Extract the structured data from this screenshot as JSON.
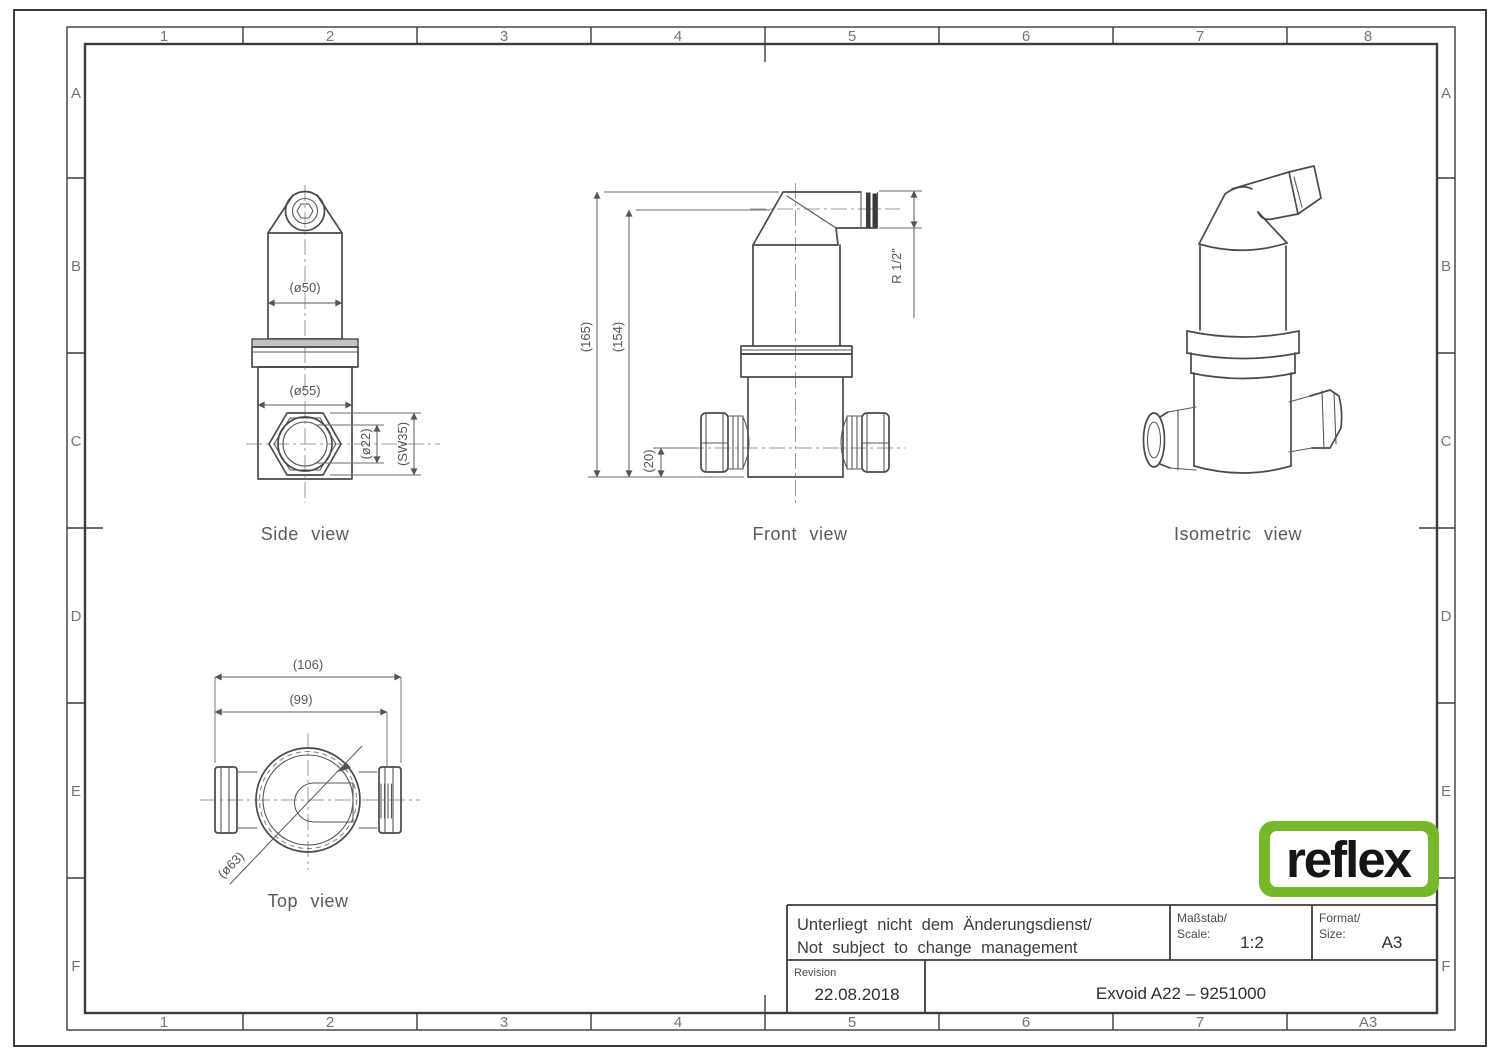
{
  "frame": {
    "cols_top": [
      "1",
      "2",
      "3",
      "4",
      "5",
      "6",
      "7",
      "8"
    ],
    "cols_bottom": [
      "1",
      "2",
      "3",
      "4",
      "5",
      "6",
      "7",
      "A3"
    ],
    "rows_left": [
      "A",
      "B",
      "C",
      "D",
      "E",
      "F"
    ],
    "rows_right": [
      "A",
      "B",
      "C",
      "D",
      "E",
      "F"
    ]
  },
  "views": {
    "side": {
      "label": "Side view",
      "dims": {
        "d50": "(ø50)",
        "d55": "(ø55)",
        "d22": "(ø22)",
        "sw35": "(SW35)"
      }
    },
    "front": {
      "label": "Front view",
      "dims": {
        "h165": "(165)",
        "h154": "(154)",
        "h20": "(20)",
        "r_half": "R 1/2\""
      }
    },
    "iso": {
      "label": "Isometric view"
    },
    "top": {
      "label": "Top view",
      "dims": {
        "w106": "(106)",
        "w99": "(99)",
        "d63": "(ø63)"
      }
    }
  },
  "title_block": {
    "note_line1": "Unterliegt nicht dem Änderungsdienst/",
    "note_line2": "Not subject to change management",
    "scale_label1": "Maßstab/",
    "scale_label2": "Scale:",
    "scale_value": "1:2",
    "format_label1": "Format/",
    "format_label2": "Size:",
    "format_value": "A3",
    "revision_label": "Revision",
    "revision_value": "22.08.2018",
    "part_title": "Exvoid A22 – 9251000"
  },
  "logo": {
    "text": "reflex",
    "green": "#76b82a"
  }
}
